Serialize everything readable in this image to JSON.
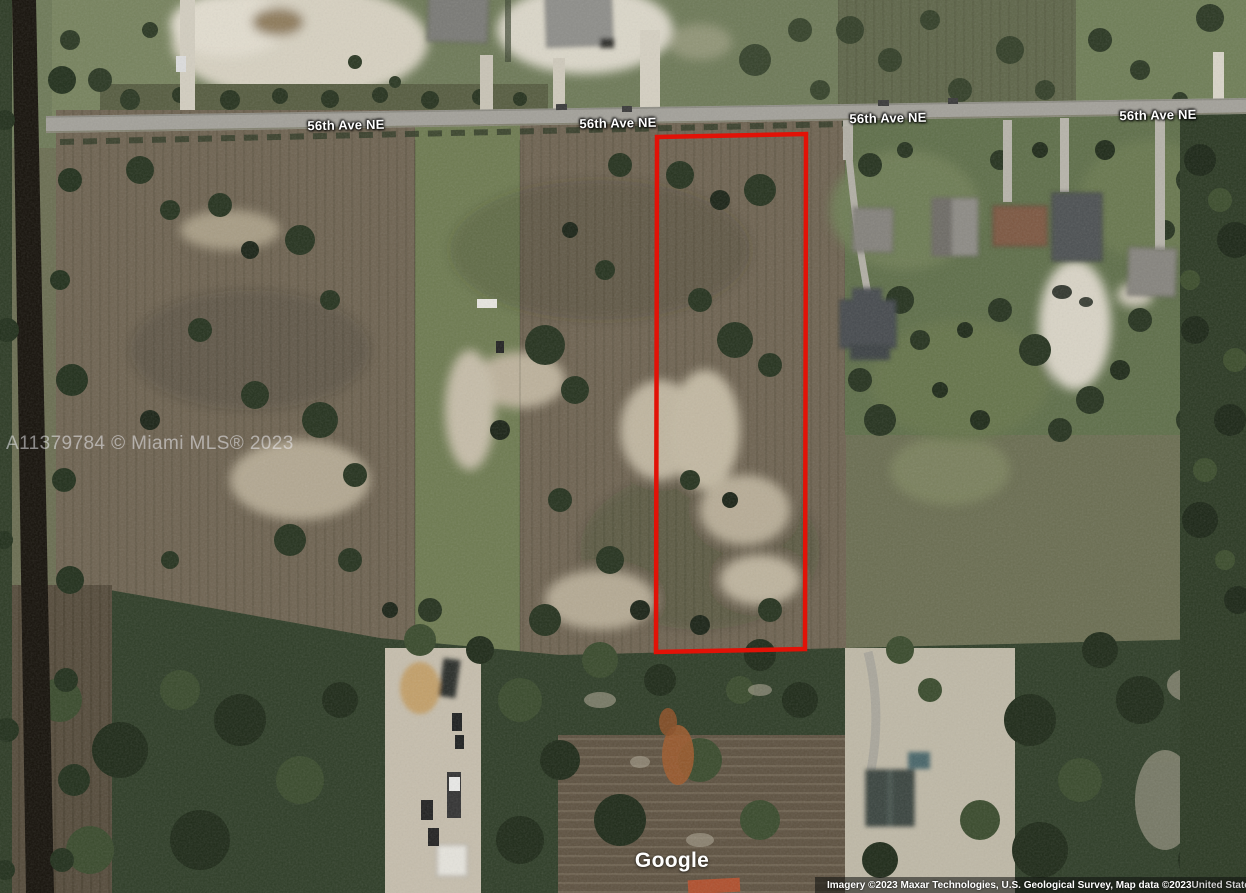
{
  "street_labels": [
    {
      "text": "56th Ave NE"
    },
    {
      "text": "56th Ave NE"
    },
    {
      "text": "56th Ave NE"
    },
    {
      "text": "56th Ave NE"
    }
  ],
  "watermark": {
    "text": "A11379784 © Miami MLS® 2023"
  },
  "parcel": {
    "outline_color": "#e21207"
  },
  "branding": {
    "logo_text": "Google"
  },
  "attribution": {
    "imagery_text": "Imagery ©2023 Maxar Technologies, U.S. Geological Survey, Map data ©2023",
    "region_text": "United States"
  }
}
